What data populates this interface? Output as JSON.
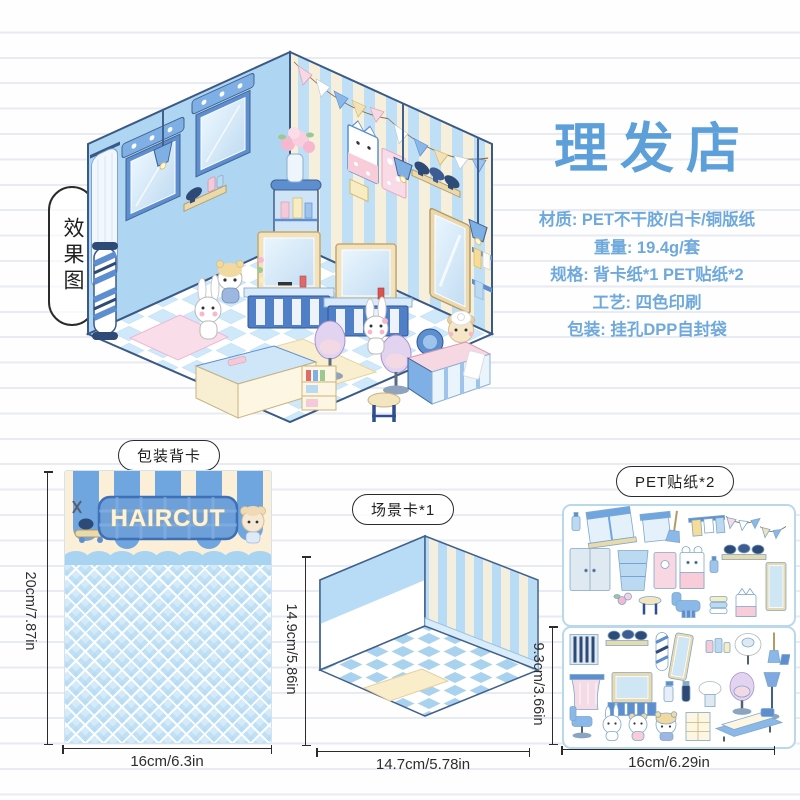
{
  "page": {
    "background": "#fefeff",
    "notebook_line_color": "#e8ebf2"
  },
  "effect_label": "效果图",
  "product": {
    "title": "理发店",
    "specs": [
      "材质: PET不干胶/白卡/铜版纸",
      "重量: 19.4g/套",
      "规格: 背卡纸*1 PET贴纸*2",
      "工艺: 四色印刷",
      "包装: 挂孔DPP自封袋"
    ]
  },
  "colors": {
    "title_blue": "#5C9FD9",
    "spec_blue": "#6FA9DC",
    "accent_blue": "#6FA6E0",
    "stripe_cream": "#F6EFDC",
    "dimension_color": "#2B2B2B"
  },
  "illustration": {
    "alt": "isometric-barbershop-room",
    "icons": [
      "window-awning-icon",
      "curtain-icon",
      "pendant-lamp-icon",
      "barber-pole-icon",
      "pennant-banner-icon",
      "cat-poster-icon",
      "pink-poster-icon",
      "hairdryer-shelf-icon",
      "wall-sconce-icon",
      "wall-mirror-icon",
      "towel-rack-icon",
      "corner-shelf-icon",
      "flower-vase-icon",
      "vanity-station-icon",
      "salon-chair-icon",
      "display-counter-icon",
      "stool-icon",
      "shampoo-station-icon",
      "pink-rug-icon",
      "cream-rug-icon",
      "bunny-character-icon",
      "hamster-character-icon",
      "bear-character-icon"
    ]
  },
  "packaging_card": {
    "label": "包装背卡",
    "banner_text": "HAIRCUT",
    "height_dim": "20cm/7.87in",
    "width_dim": "16cm/6.3in"
  },
  "scene_card": {
    "label": "场景卡*1",
    "height_dim": "14.9cm/5.86in",
    "width_dim": "14.7cm/5.78in"
  },
  "stickers": {
    "label": "PET贴纸*2",
    "sheet_count": 2,
    "height_dim": "9.3cm/3.66in",
    "width_dim": "16cm/6.29in",
    "sheet1_icons": [
      "spray-bottle",
      "double-window",
      "curtain-window",
      "broom",
      "towel-bar",
      "pennant-banner-pink",
      "pennant-banner-yellow",
      "double-door",
      "corner-shelf",
      "pink-cabinet",
      "bunny-cabinet",
      "perfume-bottle",
      "hairdryer-shelf",
      "wall-mirror",
      "plant",
      "stool",
      "barber-chair",
      "towel-stack",
      "cat-poster"
    ],
    "sheet2_icons": [
      "blinds-window",
      "hairdryer-shelf",
      "barber-pole",
      "standing-mirror",
      "cosmetics",
      "wash-basin-chair",
      "broom-dustpan",
      "curtain",
      "vanity-station",
      "pump-bottle",
      "hair-clipper",
      "wall-basin",
      "salon-chair",
      "stand-dryer",
      "office-chair",
      "bunny-character",
      "bear-character",
      "hamster-character",
      "open-cabinet",
      "shampoo-bed"
    ]
  }
}
